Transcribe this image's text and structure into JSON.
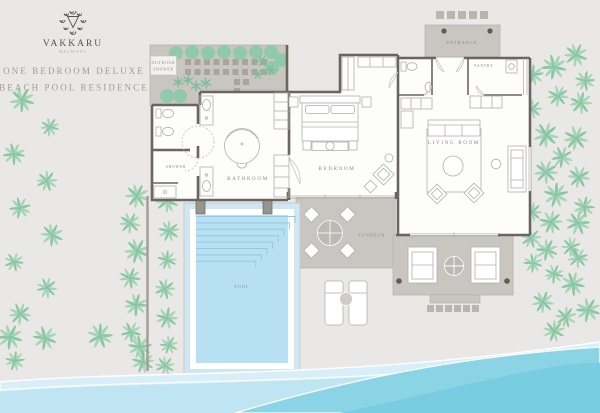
{
  "brand": {
    "name": "VAKKARU",
    "sub": "MALDIVES"
  },
  "title": {
    "line1": "ONE BEDROOM DELUXE",
    "line2": "BEACH POOL RESIDENCE"
  },
  "rooms": {
    "entrance": "ENTRANCE",
    "pantry": "PANTRY",
    "outdoor_shower_1": "OUTDOOR",
    "outdoor_shower_2": "SHOWER",
    "shower": "SHOWER",
    "bathroom": "BATHROOM",
    "bedroom": "BEDROOM",
    "living_room": "LIVING ROOM",
    "sundeck": "SUNDECK",
    "pool": "POOL"
  },
  "icons": [
    "vakkaru-logo-icon",
    "palm-tree-icon",
    "bush-icon",
    "bed-icon",
    "bathtub-icon",
    "toilet-icon",
    "vanity-sink-icon",
    "sofa-icon",
    "coffee-table-icon",
    "armchair-icon",
    "daybed-icon",
    "outdoor-dining-icon",
    "sun-lounger-icon",
    "wardrobe-icon",
    "stepping-stone-icon",
    "ocean-wave-icon"
  ],
  "colors": {
    "bg": "#e9e8e6",
    "wall": "#6b655f",
    "deck": "#c9c5c0",
    "deck_line": "#b4b0ab",
    "furniture": "#b3afaa",
    "label": "#8d8781",
    "title": "#a29b94",
    "brand": "#57534e",
    "palm1": "#9ed1b3",
    "palm2": "#82c2a0",
    "bush": "#8ccaa8",
    "pool_water": "#b7e1f3",
    "pool_frame": "#cfe7f3",
    "pool_steps": "#92c9e2",
    "wave_light": "#d8eef8",
    "wave_mid": "#bfe5f3",
    "wave_teal": "#8bd4e5",
    "wave_deep": "#79cde0",
    "fence": "#a19d98",
    "pier": "#98948e",
    "dot": "#5f5b57"
  }
}
